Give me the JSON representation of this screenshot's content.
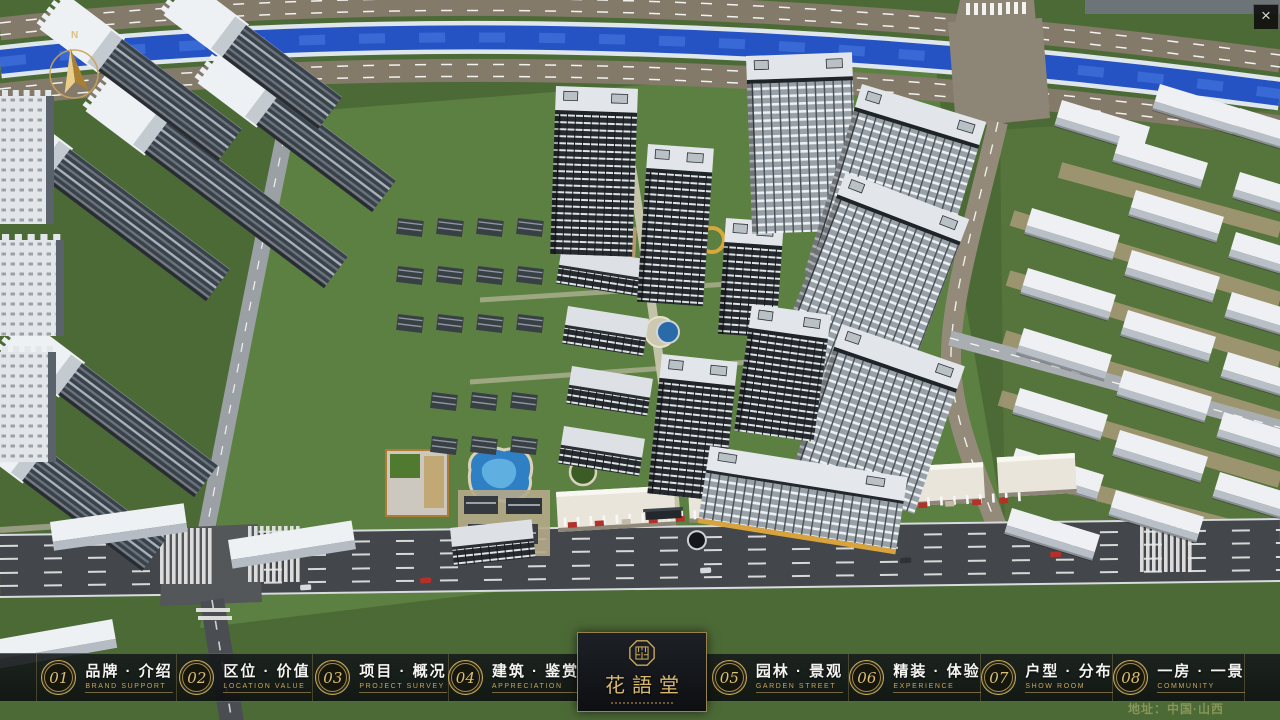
{
  "window": {
    "close": "×"
  },
  "compass": {
    "north": "N"
  },
  "logo": {
    "title": "花語堂"
  },
  "nav": {
    "items": [
      {
        "num": "01",
        "zh": "品牌 · 介绍",
        "en": "BRAND SUPPORT"
      },
      {
        "num": "02",
        "zh": "区位 · 价值",
        "en": "LOCATION VALUE"
      },
      {
        "num": "03",
        "zh": "项目 · 概况",
        "en": "PROJECT SURVEY"
      },
      {
        "num": "04",
        "zh": "建筑 · 鉴赏",
        "en": "APPRECIATION"
      },
      {
        "num": "05",
        "zh": "园林 · 景观",
        "en": "GARDEN STREET"
      },
      {
        "num": "06",
        "zh": "精装 · 体验",
        "en": "EXPERIENCE"
      },
      {
        "num": "07",
        "zh": "户型 · 分布",
        "en": "SHOW ROOM"
      },
      {
        "num": "08",
        "zh": "一房 · 一景",
        "en": "COMMUNITY"
      }
    ]
  },
  "footer": {
    "address": "地址：中国·山西"
  },
  "colors": {
    "accent_gold": "#c9a95c",
    "river_blue": "#2553c4",
    "road_dark": "#43474b",
    "bar_bg": "#101314"
  }
}
